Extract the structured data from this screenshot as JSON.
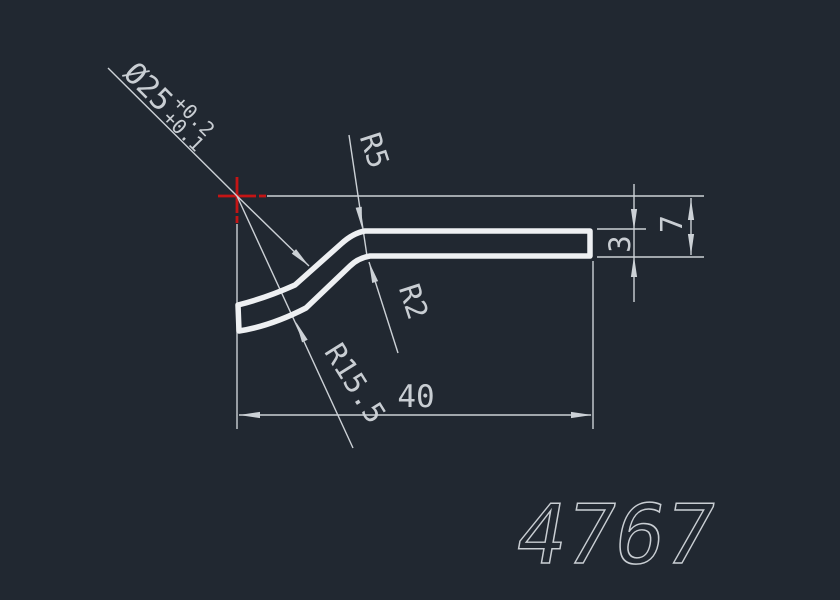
{
  "canvas": {
    "background": "#212831",
    "width": 840,
    "height": 600
  },
  "colors": {
    "line": "#ccd1d6",
    "profile": "#eef0f2",
    "crosshair": "#c41515",
    "text": "#c9ced3"
  },
  "drawing": {
    "part_number": "4767",
    "dimensions": {
      "diameter": "Ø25",
      "diameter_tolerance_upper": "+0.2",
      "diameter_tolerance_lower": "+0.1",
      "radius_outer_bend": "R5",
      "radius_inner_bend": "R2",
      "radius_large_arc": "R15.5",
      "length": "40",
      "thickness": "3",
      "height": "7"
    }
  }
}
